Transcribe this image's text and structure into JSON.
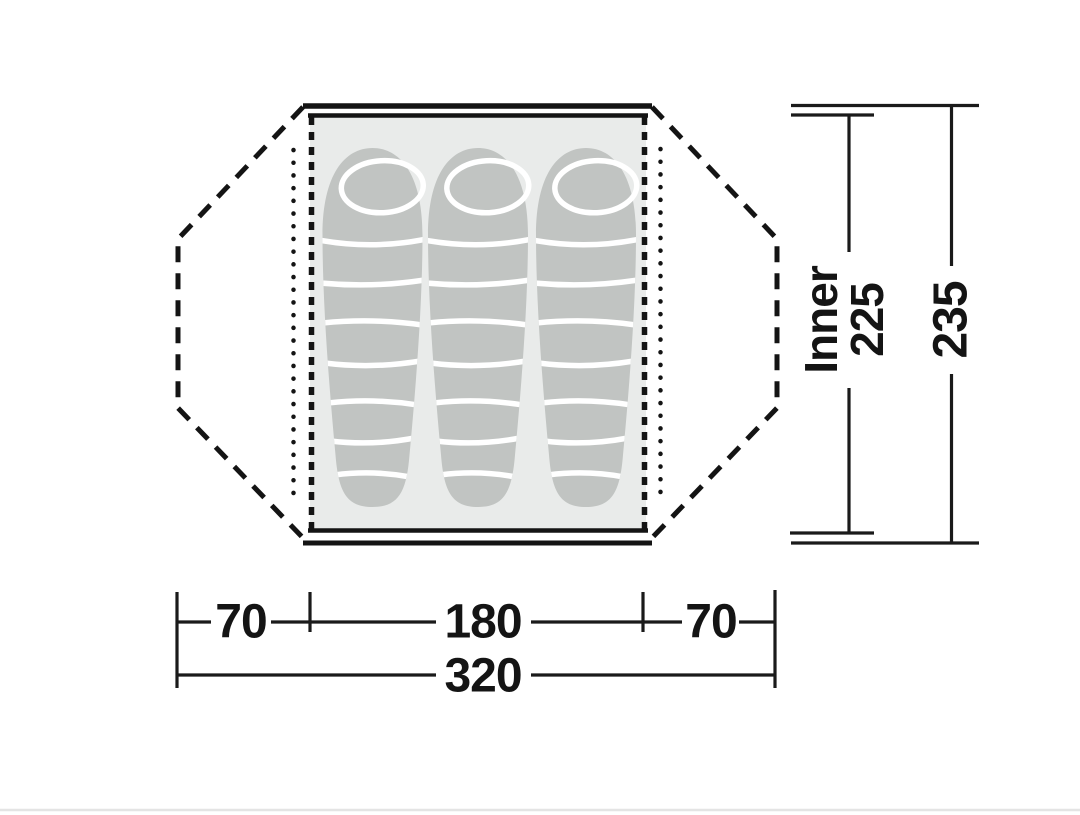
{
  "page": {
    "background": "#ffffff",
    "divider_color": "#e4e4e4"
  },
  "diagram": {
    "type": "tent-floorplan-top-view",
    "sleeping_bag_count": 3,
    "labels": {
      "inner": "Inner",
      "inner_depth": "225",
      "outer_depth": "235",
      "left_vestibule_width": "70",
      "inner_width": "180",
      "right_vestibule_width": "70",
      "total_width": "320"
    },
    "dimensions": {
      "left_vestibule": 70,
      "inner_width": 180,
      "right_vestibule": 70,
      "total_width": 320,
      "inner_depth": 225,
      "outer_depth": 235
    },
    "colors": {
      "line": "#141414",
      "inner_tent_fill": "#e9ebea",
      "sleeping_bag_fill": "#c1c4c2",
      "stripe": "#ffffff"
    }
  }
}
